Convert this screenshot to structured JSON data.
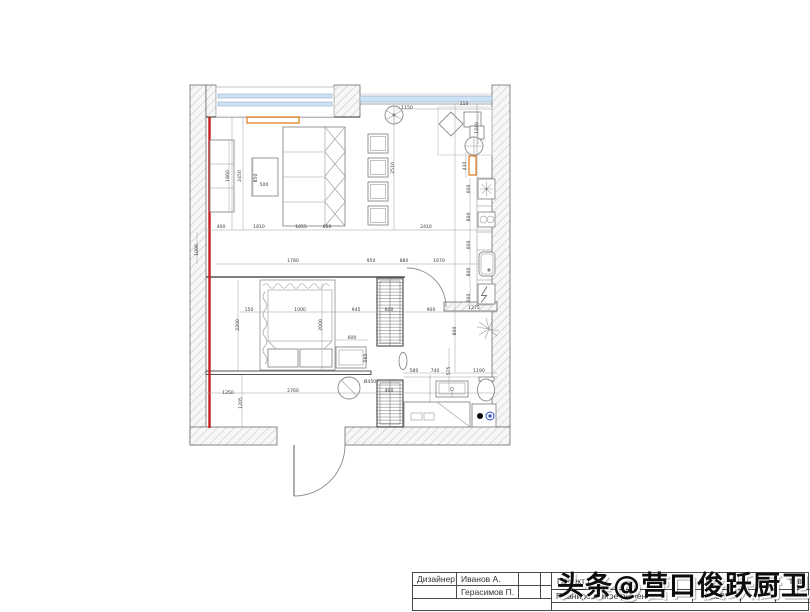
{
  "title_block": {
    "designer_label": "Дизайнер",
    "designer_name_1": "Иванов А.",
    "designer_name_2": "Герасимов П.",
    "project_prefix": "Проект Ком",
    "project_suffix": "тов",
    "drawing_title": "Планировочное решение",
    "scale": "1:50"
  },
  "watermark": {
    "text": "头条@营口俊跃厨卫"
  },
  "plan": {
    "colors": {
      "wall_line": "#6b6b6b",
      "hatch": "#c4c4c4",
      "window_fill": "#cfe2f3",
      "window_edge": "#8fb0cc",
      "highlight_red": "#c41e1e",
      "highlight_orange": "#e07818",
      "dim_text": "#3c3c3c"
    },
    "dimensions": [
      {
        "text": "400",
        "x": 221,
        "y": 228,
        "rot": 0
      },
      {
        "text": "1810",
        "x": 259,
        "y": 228,
        "rot": 0
      },
      {
        "text": "1055",
        "x": 301,
        "y": 228,
        "rot": 0
      },
      {
        "text": "600",
        "x": 327,
        "y": 228,
        "rot": 0
      },
      {
        "text": "2410",
        "x": 426,
        "y": 228,
        "rot": 0
      },
      {
        "text": "1780",
        "x": 293,
        "y": 262,
        "rot": 0
      },
      {
        "text": "950",
        "x": 371,
        "y": 262,
        "rot": 0
      },
      {
        "text": "880",
        "x": 404,
        "y": 262,
        "rot": 0
      },
      {
        "text": "1670",
        "x": 439,
        "y": 262,
        "rot": 0
      },
      {
        "text": "150",
        "x": 249,
        "y": 311,
        "rot": 0
      },
      {
        "text": "1000",
        "x": 300,
        "y": 311,
        "rot": 0
      },
      {
        "text": "945",
        "x": 356,
        "y": 311,
        "rot": 0
      },
      {
        "text": "600",
        "x": 389,
        "y": 311,
        "rot": 0
      },
      {
        "text": "900",
        "x": 431,
        "y": 311,
        "rot": 0
      },
      {
        "text": "1275",
        "x": 474,
        "y": 309,
        "rot": 0
      },
      {
        "text": "600",
        "x": 352,
        "y": 339,
        "rot": 0
      },
      {
        "text": "565",
        "x": 367,
        "y": 358,
        "rot": 90
      },
      {
        "text": "580",
        "x": 414,
        "y": 372,
        "rot": 0
      },
      {
        "text": "740",
        "x": 435,
        "y": 372,
        "rot": 0
      },
      {
        "text": "1190",
        "x": 479,
        "y": 372,
        "rot": 0
      },
      {
        "text": "1250",
        "x": 228,
        "y": 394,
        "rot": 0
      },
      {
        "text": "2760",
        "x": 293,
        "y": 392,
        "rot": 0
      },
      {
        "text": "400",
        "x": 389,
        "y": 392,
        "rot": 0
      },
      {
        "text": "1205",
        "x": 242,
        "y": 403,
        "rot": 90
      },
      {
        "text": "1090",
        "x": 198,
        "y": 250,
        "rot": 90
      },
      {
        "text": "1860",
        "x": 229,
        "y": 176,
        "rot": 90
      },
      {
        "text": "2450",
        "x": 241,
        "y": 176,
        "rot": 90
      },
      {
        "text": "850",
        "x": 257,
        "y": 178,
        "rot": 90
      },
      {
        "text": "500",
        "x": 264,
        "y": 186,
        "rot": 0
      },
      {
        "text": "2200",
        "x": 239,
        "y": 325,
        "rot": 90
      },
      {
        "text": "2000",
        "x": 322,
        "y": 325,
        "rot": 90
      },
      {
        "text": "2510",
        "x": 394,
        "y": 168,
        "rot": 90
      },
      {
        "text": "1150",
        "x": 407,
        "y": 109,
        "rot": 0
      },
      {
        "text": "110",
        "x": 464,
        "y": 105,
        "rot": 0
      },
      {
        "text": "1240",
        "x": 478,
        "y": 128,
        "rot": 90
      },
      {
        "text": "430",
        "x": 466,
        "y": 166,
        "rot": 90
      },
      {
        "text": "600",
        "x": 470,
        "y": 189,
        "rot": 90
      },
      {
        "text": "800",
        "x": 470,
        "y": 217,
        "rot": 90
      },
      {
        "text": "600",
        "x": 470,
        "y": 245,
        "rot": 90
      },
      {
        "text": "800",
        "x": 470,
        "y": 272,
        "rot": 90
      },
      {
        "text": "600",
        "x": 470,
        "y": 298,
        "rot": 90
      },
      {
        "text": "800",
        "x": 456,
        "y": 331,
        "rot": 90
      },
      {
        "text": "575",
        "x": 450,
        "y": 371,
        "rot": 90
      },
      {
        "text": "Ø450",
        "x": 370,
        "y": 383,
        "rot": 0
      }
    ]
  }
}
